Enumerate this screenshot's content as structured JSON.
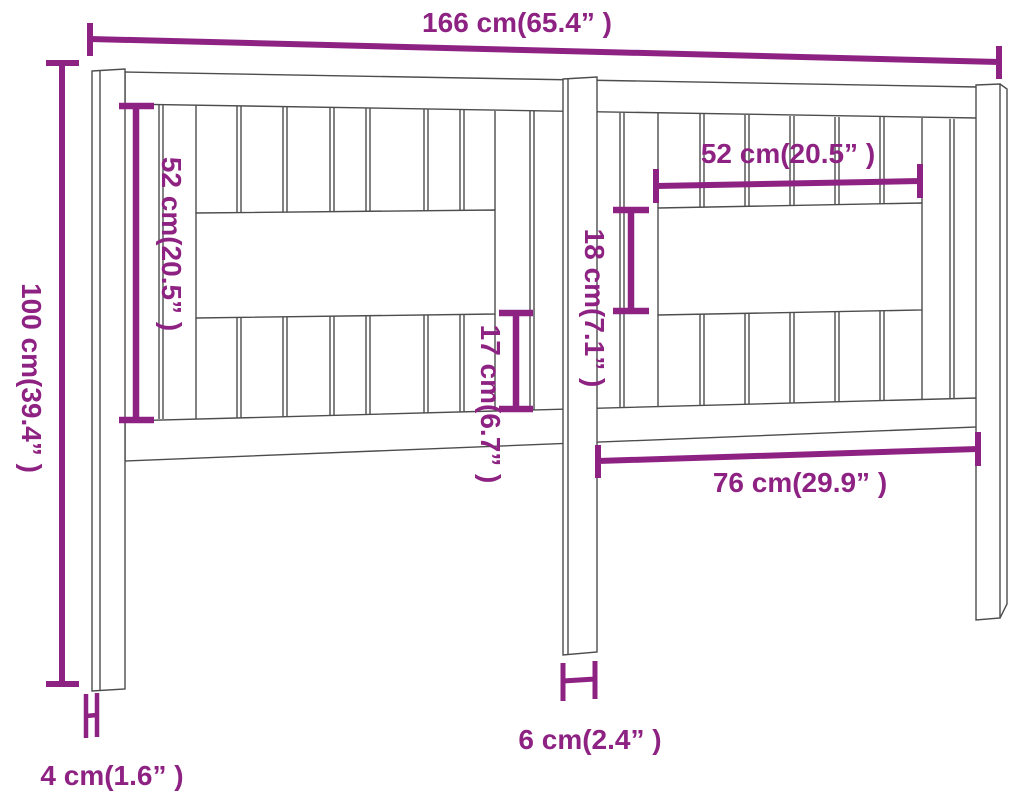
{
  "diagram": {
    "type": "furniture-dimension-drawing",
    "subject": "bed-headboard"
  },
  "dimensions": {
    "total_width": "166 cm(65.4” )",
    "total_height": "100 cm(39.4” )",
    "slat_panel_height": "52 cm(20.5” )",
    "opening_width": "52 cm(20.5” )",
    "opening_height": "18 cm(7.1” )",
    "lower_slat_height": "17 cm(6.7” )",
    "post_spacing": "76 cm(29.9” )",
    "middle_post_width": "6 cm(2.4” )",
    "post_thickness": "4 cm(1.6” )"
  },
  "colors": {
    "dimension": "#8e2283",
    "outline": "#4d4d4d",
    "background": "#ffffff"
  }
}
